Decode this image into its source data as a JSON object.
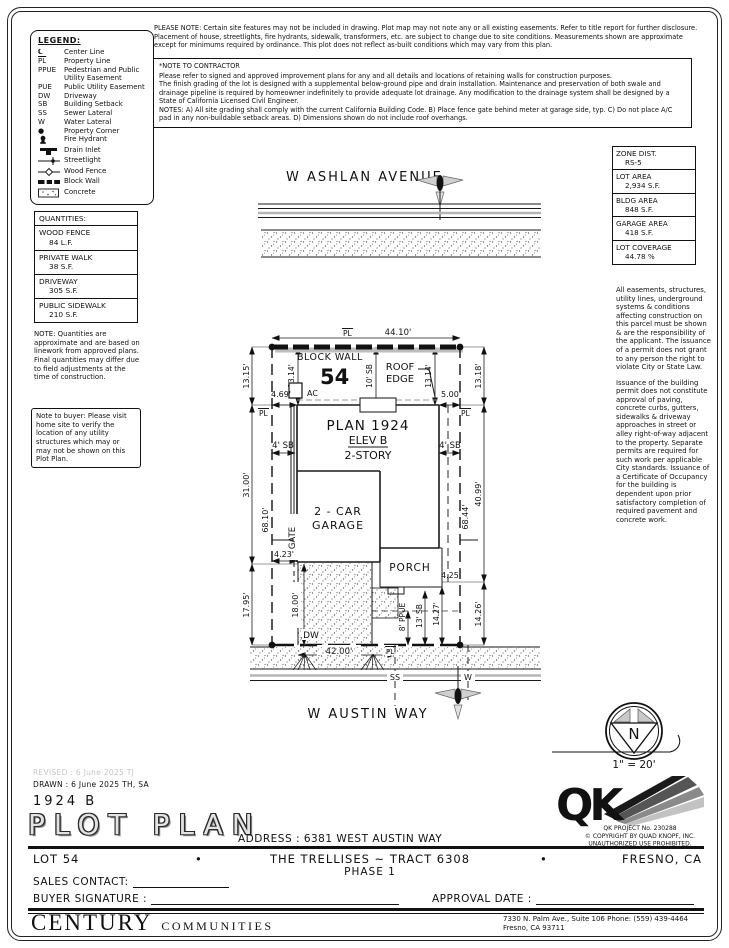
{
  "legend": {
    "title": "LEGEND:",
    "items": [
      {
        "sym": "℄",
        "label": "Center Line"
      },
      {
        "sym": "PL",
        "label": "Property Line"
      },
      {
        "sym": "PPUE",
        "label": "Pedestrian and Public Utility Easement"
      },
      {
        "sym": "PUE",
        "label": "Public Utility Easement"
      },
      {
        "sym": "DW",
        "label": "Driveway"
      },
      {
        "sym": "SB",
        "label": "Building Setback"
      },
      {
        "sym": "SS",
        "label": "Sewer Lateral"
      },
      {
        "sym": "W",
        "label": "Water Lateral"
      },
      {
        "sym": "●",
        "label": "Property Corner"
      },
      {
        "sym": "",
        "label": "Fire Hydrant",
        "icon": "fire-hydrant"
      },
      {
        "sym": "",
        "label": "Drain Inlet",
        "icon": "drain-inlet"
      },
      {
        "sym": "",
        "label": "Streetlight",
        "icon": "streetlight"
      },
      {
        "sym": "",
        "label": "Wood Fence",
        "icon": "wood-fence"
      },
      {
        "sym": "",
        "label": "Block Wall",
        "icon": "block-wall"
      },
      {
        "sym": "",
        "label": "Concrete",
        "icon": "concrete"
      }
    ]
  },
  "top_note": "PLEASE NOTE:  Certain site features may not be included in drawing.  Plot map may not note any or all existing easements. Refer to title report for further disclosure.  Placement of house, streetlights, fire hydrants, sidewalk, transformers, etc. are subject to change due to site conditions.  Measurements shown are approximate except for minimums required by ordinance.  This plot does not reflect as-built conditions which may vary from this plan.",
  "contractor_note": {
    "title": "*NOTE TO CONTRACTOR",
    "p1": "Please refer to signed and approved improvement plans for any and all details and locations of retaining walls for construction purposes.",
    "p2": "The finish grading of the lot is designed with a supplemental below-ground pipe and drain installation.  Maintenance and preservation of both swale and drainage pipeline is required by homeowner indefinitely to provide adequate lot drainage.  Any modification to the drainage system shall be designed by a State of California Licensed Civil Engineer.",
    "p3": "NOTES:  A) All site grading shall comply with the current California Building Code.  B) Place fence gate behind meter at garage side, typ.  C) Do not place A/C pad in any non-buildable setback areas.  D) Dimensions shown do not include roof overhangs."
  },
  "quantities": {
    "title": "QUANTITIES:",
    "items": [
      {
        "name": "WOOD FENCE",
        "value": "84 L.F."
      },
      {
        "name": "PRIVATE WALK",
        "value": "38 S.F."
      },
      {
        "name": "DRIVEWAY",
        "value": "305 S.F."
      },
      {
        "name": "PUBLIC SIDEWALK",
        "value": "210 S.F."
      }
    ],
    "note": "NOTE: Quantities are approximate and are based on linework from approved plans.  Final quantities may differ due to field adjustments at the time of construction.",
    "buyer_note": "Note to buyer: Please visit home site to verify the location of any utility structures which may or may not be shown on this Plot Plan."
  },
  "site_info": {
    "rows": [
      {
        "label": "ZONE DIST.",
        "value": "RS-5"
      },
      {
        "label": "LOT AREA",
        "value": "2,934 S.F."
      },
      {
        "label": "BLDG AREA",
        "value": "848 S.F."
      },
      {
        "label": "GARAGE AREA",
        "value": "418 S.F."
      },
      {
        "label": "LOT COVERAGE",
        "value": "44.78 %"
      }
    ],
    "note1": "All easements, structures, utility lines, underground systems & conditions affecting construction on this parcel must be shown & are the responsibility of the applicant. The issuance of a permit does not grant to any person the right to violate City or State Law.",
    "note2": "Issuance of the building permit does not constitute approval of paving, concrete curbs, gutters, sidewalks & driveway approaches in street or alley right-of-way adjacent to the property. Separate permits are required for such work per applicable City standards. Issuance of a Certificate of Occupancy for the building is dependent upon prior satisfactory completion of required pavement and concrete work."
  },
  "plot": {
    "street_top": "W ASHLAN AVENUE",
    "street_bottom": "W AUSTIN WAY",
    "pl": "PL",
    "dim_top": "44.10'",
    "dim_left_1": "13.15'",
    "dim_left_2": "31.00'",
    "dim_left_3": "17.95'",
    "dim_right_1": "13.18'",
    "dim_right_2": "40.99'",
    "dim_right_3": "14.26'",
    "dim_inner_left": "13.14'",
    "dim_inner_right": "13.14'",
    "setback_front": "10' SB",
    "block_wall": "BLOCK WALL",
    "lot_number": "54",
    "roof_edge_1": "ROOF",
    "roof_edge_2": "EDGE",
    "ac_label": "AC",
    "dim_house_left": "4.69'",
    "dim_house_right": "5.00'",
    "plan_name": "PLAN 1924",
    "plan_elev": "ELEV B",
    "plan_story": "2-STORY",
    "setback_side": "4' SB",
    "elev_left": "68.10'",
    "elev_right": "68.44'",
    "gate": "GATE",
    "dim_gate": "4.23'",
    "garage_line_1": "2 - CAR",
    "garage_line_2": "GARAGE",
    "porch": "PORCH",
    "dim_porch": "4.25'",
    "dim_driveway": "18.00'",
    "dw_label": "DW",
    "dim_frontage": "42.00'",
    "ppue": "8' PPUE",
    "setback_rear": "13' SB",
    "dim_rear": "14.27'",
    "sewer_label": "SS",
    "water_label": "W"
  },
  "compass": {
    "north": "N",
    "scale": "1\" = 20'"
  },
  "title_block": {
    "revised": "REVISED :  6 June 2025   TJ",
    "drawn": "DRAWN :  6 June 2025   TH, SA",
    "plan_num": "1924  B",
    "title": "PLOT PLAN",
    "address": "ADDRESS :   6381 WEST AUSTIN WAY",
    "qk_project": "QK PROJECT No. 230288",
    "qk_copyright": "©  COPYRIGHT BY QUAD KNOPF, INC.",
    "qk_unauthorized": "UNAUTHORIZED USE PROHIBITED.",
    "qk_letters": "QK",
    "lot": "LOT 54",
    "bullet": "•",
    "tract": "THE TRELLISES ~ TRACT 6308",
    "phase": "PHASE 1",
    "city": "FRESNO, CA",
    "sales_contact_label": "SALES CONTACT:",
    "buyer_signature_label": "BUYER SIGNATURE :",
    "approval_date_label": "APPROVAL DATE :"
  },
  "footer": {
    "brand_1": "CENTURY",
    "brand_2": "COMMUNITIES",
    "address_line_1": "7330 N. Palm Ave., Suite 106    Phone:  (559) 439-4464",
    "address_line_2": "Fresno, CA  93711"
  }
}
